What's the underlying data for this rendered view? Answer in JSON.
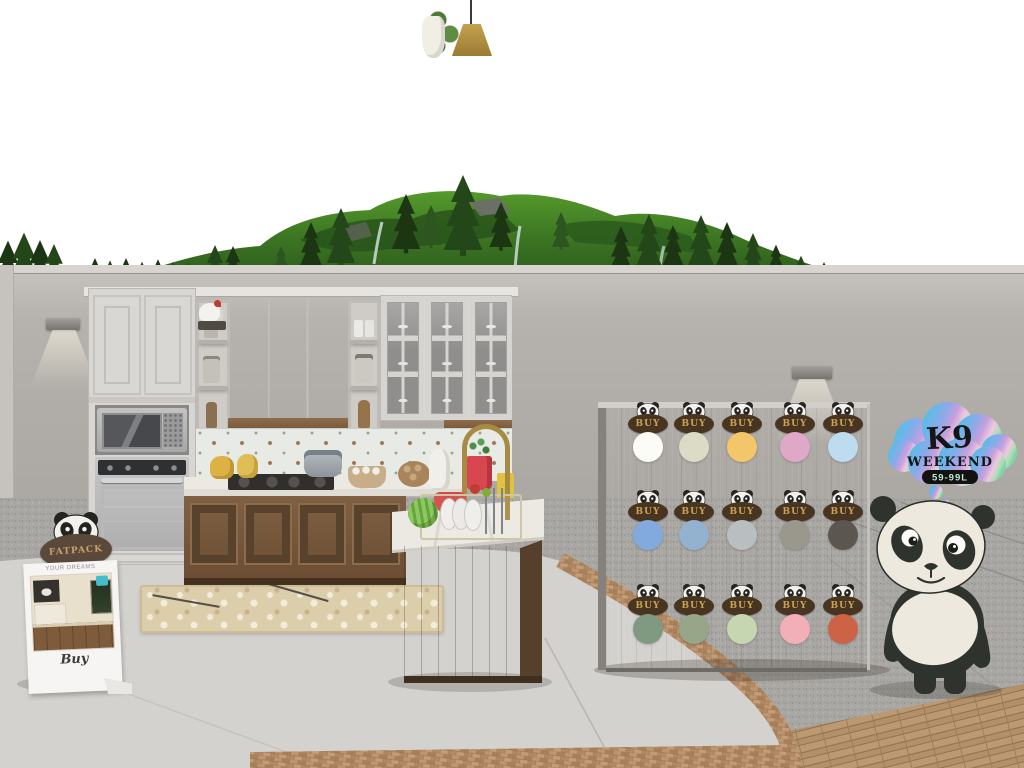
{
  "scene_colors": {
    "sky": "#ffffff",
    "wall": "#b3afab",
    "smooth_concrete": "#d4d2ce",
    "granite": "#a9a7a3",
    "brick": "#b28a64",
    "deck_wood": "#b6946c",
    "cabinet_white": "#d8d6d2",
    "cabinet_wood": "#76573b",
    "panda_dark": "#2f332d",
    "panda_cream": "#eee9df"
  },
  "fatpack_sign": {
    "badge_label": "FATPACK",
    "header": "YOUR DREAMS",
    "buy_label": "Buy"
  },
  "k9_sign": {
    "title": "K9",
    "subtitle": "WEEKEND",
    "price": "59-99L"
  },
  "vendor_board": {
    "buy_label": "BUY",
    "buy_button_color": "#483521",
    "buy_text_color": "#c9a254",
    "swatch_rows": [
      {
        "name": "row-1",
        "colors": [
          "#fcfcf6",
          "#dcdbc5",
          "#f3c66a",
          "#dfa8c7",
          "#bddcf0"
        ]
      },
      {
        "name": "row-2",
        "colors": [
          "#82aade",
          "#92b2cf",
          "#b9bfc0",
          "#9a978c",
          "#5c5650"
        ]
      },
      {
        "name": "row-3",
        "colors": [
          "#7f9a81",
          "#97a689",
          "#c5d6b1",
          "#f2afb8",
          "#cd6346"
        ]
      }
    ]
  },
  "icons": {
    "buy_button_icon": "panda-icon",
    "mascot": "panda-mascot"
  }
}
